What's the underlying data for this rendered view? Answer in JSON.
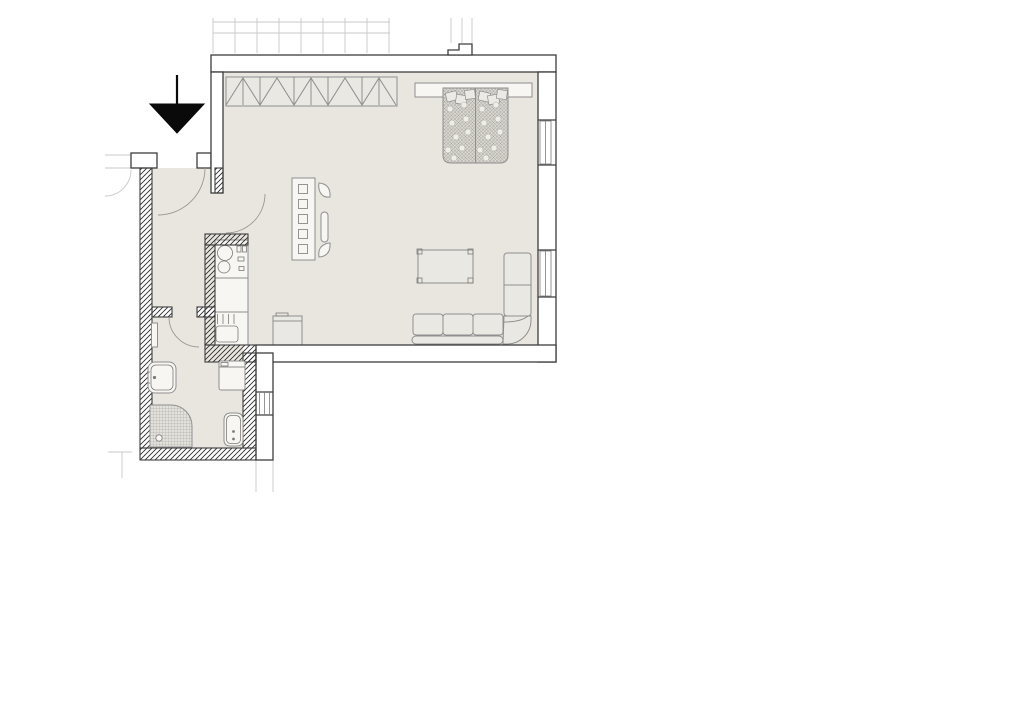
{
  "theme": {
    "background": "#ffffff",
    "floor": "#e9e6e0",
    "wall_fill": "#ffffff",
    "wall_stroke": "#3d3d3d",
    "hatch_stroke": "#2e2e2e",
    "furniture_fill": "#eae8e2",
    "furniture_stroke": "#8f8f8f",
    "bed_fill": "#d9d6d0",
    "faint_line": "#c9c9c9",
    "arrow_color": "#0a0a0a"
  },
  "plan": {
    "type": "apartment-floor-plan",
    "entrance_marker": "down-arrow",
    "window_count": 3,
    "door_swing_count": 3,
    "rooms": [
      {
        "name": "main-room",
        "furniture": [
          "wardrobe",
          "double-bed",
          "shelving-unit",
          "chair",
          "coffee-table",
          "corner-sofa",
          "stool"
        ]
      },
      {
        "name": "kitchen",
        "furniture": [
          "kitchen-counter",
          "cooktop",
          "kitchen-sink"
        ]
      },
      {
        "name": "entry-hall",
        "furniture": []
      },
      {
        "name": "bathroom",
        "furniture": [
          "radiator",
          "washbasin",
          "washing-machine",
          "shower",
          "toilet"
        ]
      }
    ]
  }
}
